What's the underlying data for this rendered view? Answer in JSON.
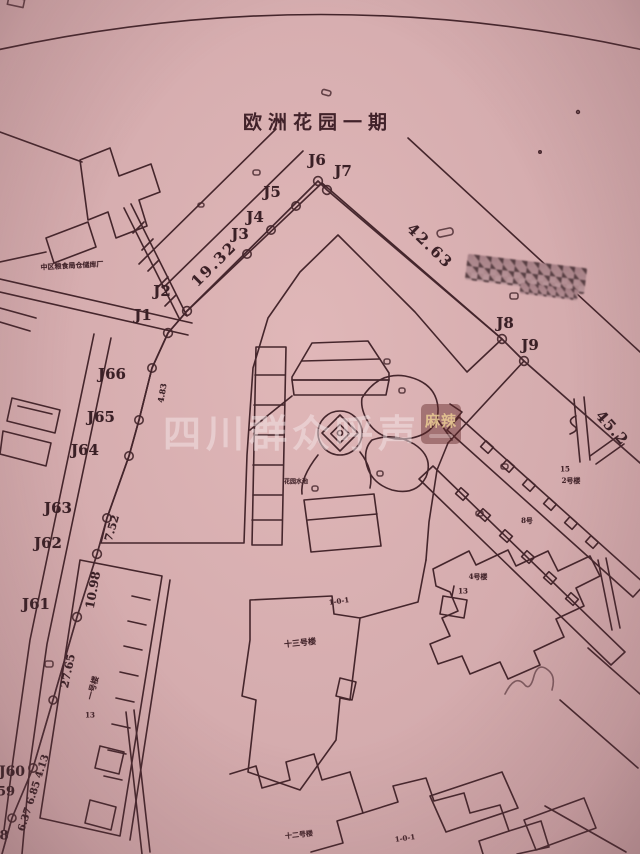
{
  "document": {
    "title": "欧洲花园一期"
  },
  "watermark": {
    "text": "四川群众呼声",
    "badge": "麻辣"
  },
  "colors": {
    "paper": "#d6adaf",
    "ink": "#45262c",
    "boundary_red": "#c5525b",
    "highlight_yellow": "#d6b93a"
  },
  "point_labels": [
    {
      "id": "J6",
      "text": "J6",
      "x": 317,
      "y": 160
    },
    {
      "id": "J7",
      "text": "J7",
      "x": 343,
      "y": 171
    },
    {
      "id": "J5",
      "text": "J5",
      "x": 272,
      "y": 192
    },
    {
      "id": "J4",
      "text": "J4",
      "x": 255,
      "y": 217
    },
    {
      "id": "J3",
      "text": "J3",
      "x": 240,
      "y": 234
    },
    {
      "id": "J2",
      "text": "J2",
      "x": 162,
      "y": 291
    },
    {
      "id": "J1",
      "text": "J1",
      "x": 143,
      "y": 315
    },
    {
      "id": "J66",
      "text": "J66",
      "x": 112,
      "y": 374
    },
    {
      "id": "J65",
      "text": "J65",
      "x": 101,
      "y": 417
    },
    {
      "id": "J64",
      "text": "J64",
      "x": 85,
      "y": 450
    },
    {
      "id": "J63",
      "text": "J63",
      "x": 58,
      "y": 508
    },
    {
      "id": "J62",
      "text": "J62",
      "x": 48,
      "y": 543
    },
    {
      "id": "J61",
      "text": "J61",
      "x": 36,
      "y": 604
    },
    {
      "id": "J60",
      "text": "J60",
      "x": 12,
      "y": 772,
      "size": 14
    },
    {
      "id": "J59",
      "text": "59",
      "x": 6,
      "y": 792,
      "size": 13
    },
    {
      "id": "J58",
      "text": "8",
      "x": 4,
      "y": 836,
      "size": 13
    },
    {
      "id": "J8",
      "text": "J8",
      "x": 505,
      "y": 323
    },
    {
      "id": "J9",
      "text": "J9",
      "x": 530,
      "y": 345
    }
  ],
  "distance_labels": [
    {
      "id": "d1",
      "text": "19.32",
      "x": 214,
      "y": 264,
      "rot": -45,
      "size": 15,
      "ls": 2
    },
    {
      "id": "d2",
      "text": "42.63",
      "x": 430,
      "y": 246,
      "rot": 44,
      "size": 15,
      "ls": 2
    },
    {
      "id": "d3",
      "text": "45.2",
      "x": 612,
      "y": 428,
      "rot": 48,
      "size": 15,
      "ls": 1
    },
    {
      "id": "d4",
      "text": "10.98",
      "x": 93,
      "y": 590,
      "rot": -80,
      "size": 12
    },
    {
      "id": "d5",
      "text": "7.52",
      "x": 112,
      "y": 528,
      "rot": -74,
      "size": 11
    },
    {
      "id": "d6",
      "text": "27.65",
      "x": 68,
      "y": 671,
      "rot": -78,
      "size": 11
    },
    {
      "id": "d7",
      "text": "6.37 6.85 4.13",
      "x": 34,
      "y": 793,
      "rot": -72,
      "size": 10
    },
    {
      "id": "d8",
      "text": "4.83",
      "x": 162,
      "y": 393,
      "rot": -80,
      "size": 8
    }
  ],
  "area_labels": [
    {
      "id": "factory",
      "text": "中区粮食局仓储库厂",
      "x": 72,
      "y": 266,
      "size": 7,
      "rot": -3
    },
    {
      "id": "bldg1",
      "text": "一号楼",
      "x": 93,
      "y": 688,
      "rot": -75,
      "size": 8
    },
    {
      "id": "n13a",
      "text": "13",
      "x": 90,
      "y": 715,
      "size": 7
    },
    {
      "id": "bldg13",
      "text": "十三号楼",
      "x": 300,
      "y": 643,
      "rot": -6,
      "size": 8
    },
    {
      "id": "unit101a",
      "text": "1-0-1",
      "x": 339,
      "y": 601,
      "rot": -8,
      "size": 7
    },
    {
      "id": "bldg12",
      "text": "十二号楼",
      "x": 299,
      "y": 835,
      "rot": -6,
      "size": 7
    },
    {
      "id": "unit101b",
      "text": "1-0-1",
      "x": 405,
      "y": 838,
      "rot": -8,
      "size": 7
    },
    {
      "id": "n15",
      "text": "15",
      "x": 565,
      "y": 469,
      "size": 7
    },
    {
      "id": "bldg2",
      "text": "2号楼",
      "x": 571,
      "y": 481,
      "size": 7
    },
    {
      "id": "bldg8",
      "text": "8号",
      "x": 527,
      "y": 521,
      "size": 7
    },
    {
      "id": "bldg4",
      "text": "4号楼",
      "x": 478,
      "y": 577,
      "size": 7
    },
    {
      "id": "n13b",
      "text": "13",
      "x": 463,
      "y": 591,
      "size": 7
    },
    {
      "id": "garden",
      "text": "花园水池",
      "x": 296,
      "y": 481,
      "size": 6
    }
  ]
}
